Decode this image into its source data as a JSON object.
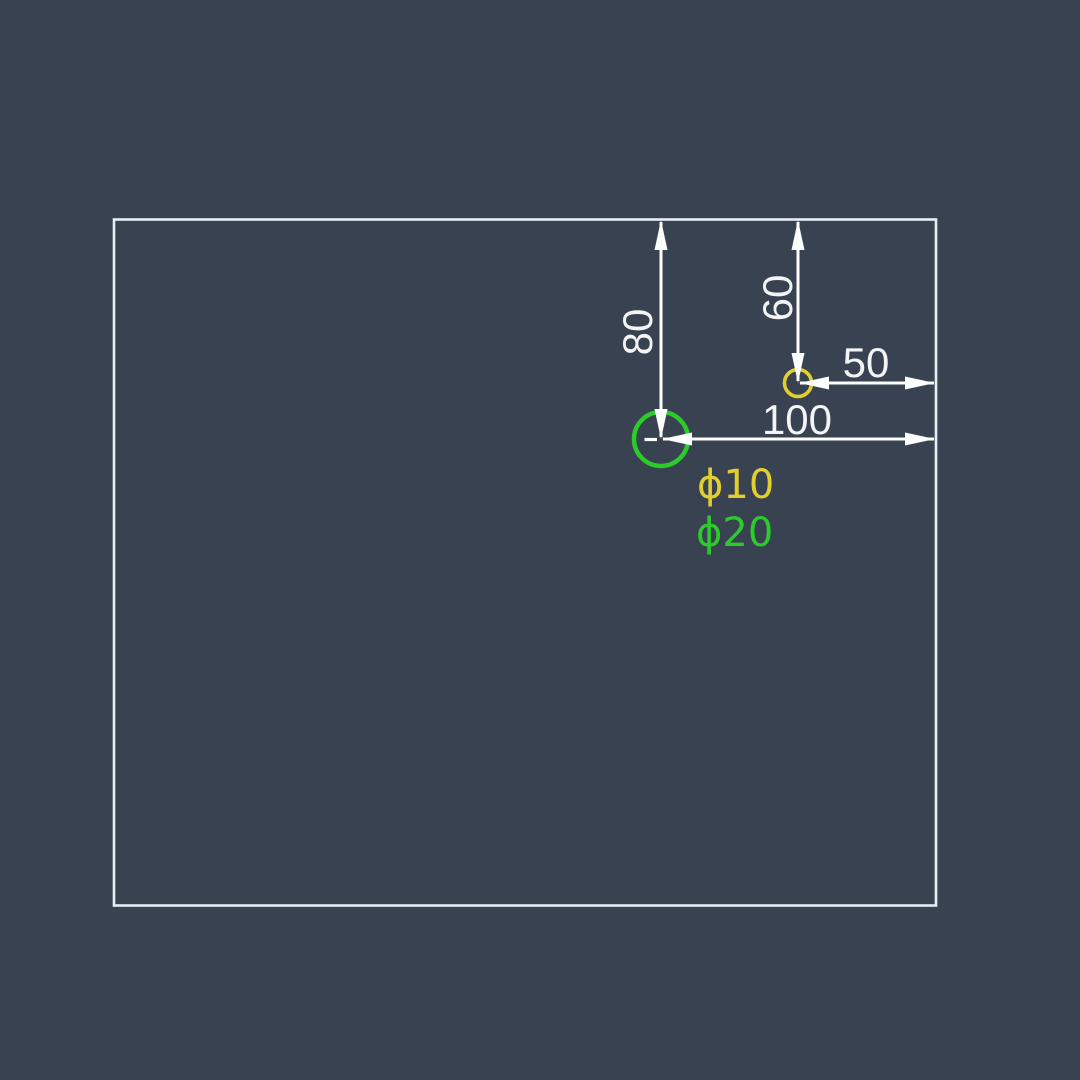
{
  "colors": {
    "bg": "#394251",
    "outline": "#e7edf4",
    "dim": "#fdfefe",
    "dimtext": "#f2f4f6",
    "yellow": "#e2cf2e",
    "green": "#2ccb2c"
  },
  "dimensions": {
    "d80": {
      "label": "80",
      "orientation": "vertical",
      "measures": "large hole center to top edge"
    },
    "d60": {
      "label": "60",
      "orientation": "vertical",
      "measures": "small hole center to top edge"
    },
    "d50": {
      "label": "50",
      "orientation": "horizontal",
      "measures": "small hole center to right edge"
    },
    "d100": {
      "label": "100",
      "orientation": "horizontal",
      "measures": "large hole center to right edge"
    }
  },
  "holes": {
    "small": {
      "label": "ϕ10",
      "diameter": "10",
      "color": "#e2cf2e"
    },
    "large": {
      "label": "ϕ20",
      "diameter": "20",
      "color": "#2ccb2c"
    }
  }
}
